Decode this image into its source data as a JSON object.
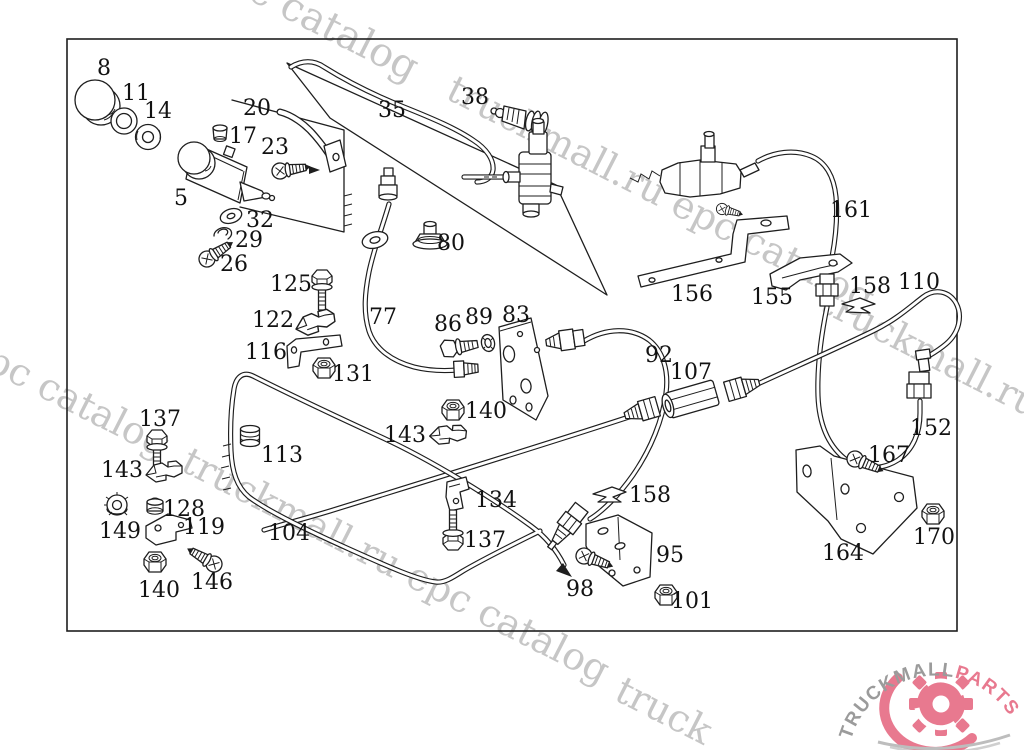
{
  "diagram": {
    "description": "Exploded parts diagram - clutch hydraulic lines, master and slave cylinder, pipes, hoses, brackets and fasteners",
    "part_labels": [
      {
        "t": "8",
        "x": 104,
        "y": 67
      },
      {
        "t": "11",
        "x": 136,
        "y": 92
      },
      {
        "t": "14",
        "x": 158,
        "y": 110
      },
      {
        "t": "20",
        "x": 257,
        "y": 107
      },
      {
        "t": "17",
        "x": 243,
        "y": 135
      },
      {
        "t": "23",
        "x": 275,
        "y": 146
      },
      {
        "t": "35",
        "x": 392,
        "y": 109
      },
      {
        "t": "38",
        "x": 475,
        "y": 96
      },
      {
        "t": "5",
        "x": 181,
        "y": 197
      },
      {
        "t": "32",
        "x": 260,
        "y": 219
      },
      {
        "t": "29",
        "x": 249,
        "y": 239
      },
      {
        "t": "26",
        "x": 234,
        "y": 263
      },
      {
        "t": "80",
        "x": 451,
        "y": 242
      },
      {
        "t": "161",
        "x": 851,
        "y": 209
      },
      {
        "t": "125",
        "x": 291,
        "y": 283
      },
      {
        "t": "122",
        "x": 273,
        "y": 319
      },
      {
        "t": "116",
        "x": 266,
        "y": 351
      },
      {
        "t": "131",
        "x": 353,
        "y": 373
      },
      {
        "t": "77",
        "x": 383,
        "y": 316
      },
      {
        "t": "86",
        "x": 448,
        "y": 323
      },
      {
        "t": "89",
        "x": 479,
        "y": 316
      },
      {
        "t": "83",
        "x": 516,
        "y": 314
      },
      {
        "t": "156",
        "x": 692,
        "y": 293
      },
      {
        "t": "155",
        "x": 772,
        "y": 296
      },
      {
        "t": "158",
        "x": 870,
        "y": 285
      },
      {
        "t": "110",
        "x": 919,
        "y": 281
      },
      {
        "t": "92",
        "x": 659,
        "y": 354
      },
      {
        "t": "107",
        "x": 691,
        "y": 371
      },
      {
        "t": "140",
        "x": 486,
        "y": 410
      },
      {
        "t": "143",
        "x": 405,
        "y": 434
      },
      {
        "t": "113",
        "x": 282,
        "y": 454
      },
      {
        "t": "137",
        "x": 160,
        "y": 418
      },
      {
        "t": "143",
        "x": 122,
        "y": 469
      },
      {
        "t": "128",
        "x": 184,
        "y": 508
      },
      {
        "t": "149",
        "x": 120,
        "y": 530
      },
      {
        "t": "119",
        "x": 204,
        "y": 526
      },
      {
        "t": "104",
        "x": 289,
        "y": 532
      },
      {
        "t": "134",
        "x": 496,
        "y": 499
      },
      {
        "t": "137",
        "x": 485,
        "y": 539
      },
      {
        "t": "158",
        "x": 650,
        "y": 494
      },
      {
        "t": "95",
        "x": 670,
        "y": 554
      },
      {
        "t": "98",
        "x": 580,
        "y": 588
      },
      {
        "t": "101",
        "x": 692,
        "y": 600
      },
      {
        "t": "146",
        "x": 212,
        "y": 581
      },
      {
        "t": "140",
        "x": 159,
        "y": 589
      },
      {
        "t": "152",
        "x": 931,
        "y": 427
      },
      {
        "t": "167",
        "x": 889,
        "y": 454
      },
      {
        "t": "164",
        "x": 843,
        "y": 552
      },
      {
        "t": "170",
        "x": 934,
        "y": 536
      }
    ],
    "watermarks": [
      {
        "text": "c catalog",
        "x": 328,
        "y": 40,
        "angle": 27,
        "size": 40
      },
      {
        "text": "truckmall.ru epc catalog",
        "x": 655,
        "y": 205,
        "angle": 27,
        "size": 38
      },
      {
        "text": "epc catalog",
        "x": 62,
        "y": 408,
        "angle": 27,
        "size": 38
      },
      {
        "text": "truckmall.ru epc catalog",
        "x": 390,
        "y": 577,
        "angle": 27,
        "size": 38
      },
      {
        "text": "truckmall.ru e",
        "x": 940,
        "y": 372,
        "angle": 27,
        "size": 38
      },
      {
        "text": "truck",
        "x": 658,
        "y": 722,
        "angle": 27,
        "size": 38
      }
    ]
  },
  "logo": {
    "text_gray": "TRUCKMALL",
    "text_pink": "PARTS"
  },
  "colors": {
    "line": "#1e1e1e",
    "watermark": "#c6c6c6",
    "logo_gray": "#9b9b9b",
    "logo_pink": "#e8798f",
    "background": "#ffffff"
  }
}
